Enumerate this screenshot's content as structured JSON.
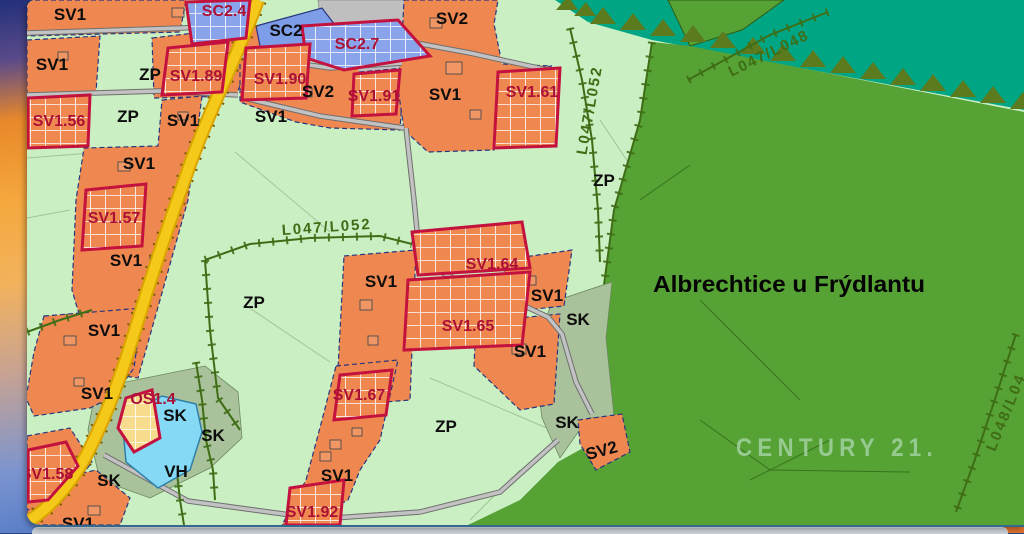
{
  "map": {
    "region_title": "Albrechtice u Frýdlantu",
    "watermark": "CENTURY 21.",
    "zone_labels": [
      "SV1",
      "SV1",
      "ZP",
      "SC2",
      "SV2",
      "SV2",
      "SV1",
      "ZP",
      "SV1",
      "SV1",
      "SV1",
      "ZP",
      "SV1",
      "ZP",
      "SV1",
      "SV1",
      "SK",
      "SV1",
      "SV1",
      "SV1",
      "SK",
      "SK",
      "SK",
      "VH",
      "ZP",
      "SK",
      "SV1",
      "SV2",
      "SV1"
    ],
    "parcel_labels": [
      "SC2.4",
      "SV1.89",
      "SV1.90",
      "SC2.7",
      "SV1.91",
      "SV1.61",
      "SV1.56",
      "SV1.57",
      "SV1.64",
      "SV1.65",
      "SV1.67",
      "OS1.4",
      "SV1.58",
      "SV1.92"
    ],
    "road_labels": [
      "L047/L052",
      "L047/L052",
      "L047/L048",
      "L048/L04"
    ],
    "colors": {
      "residential_orange": "#ef8850",
      "mixed_use_blue": "#7d9de8",
      "greenery_light": "#c9efc3",
      "forest_green": "#56a235",
      "forest_teal": "#00a584",
      "water_blue": "#85d9f4",
      "sk_gray_green": "#a9c29b",
      "reserve_yellow": "#f8dc8e",
      "road_yellow": "#f5c91a",
      "road_gray": "#c2c2c2",
      "parcel_border_red": "#c4123f",
      "parcel_label_red": "#ab1035",
      "path_green": "#3f6d15"
    }
  }
}
